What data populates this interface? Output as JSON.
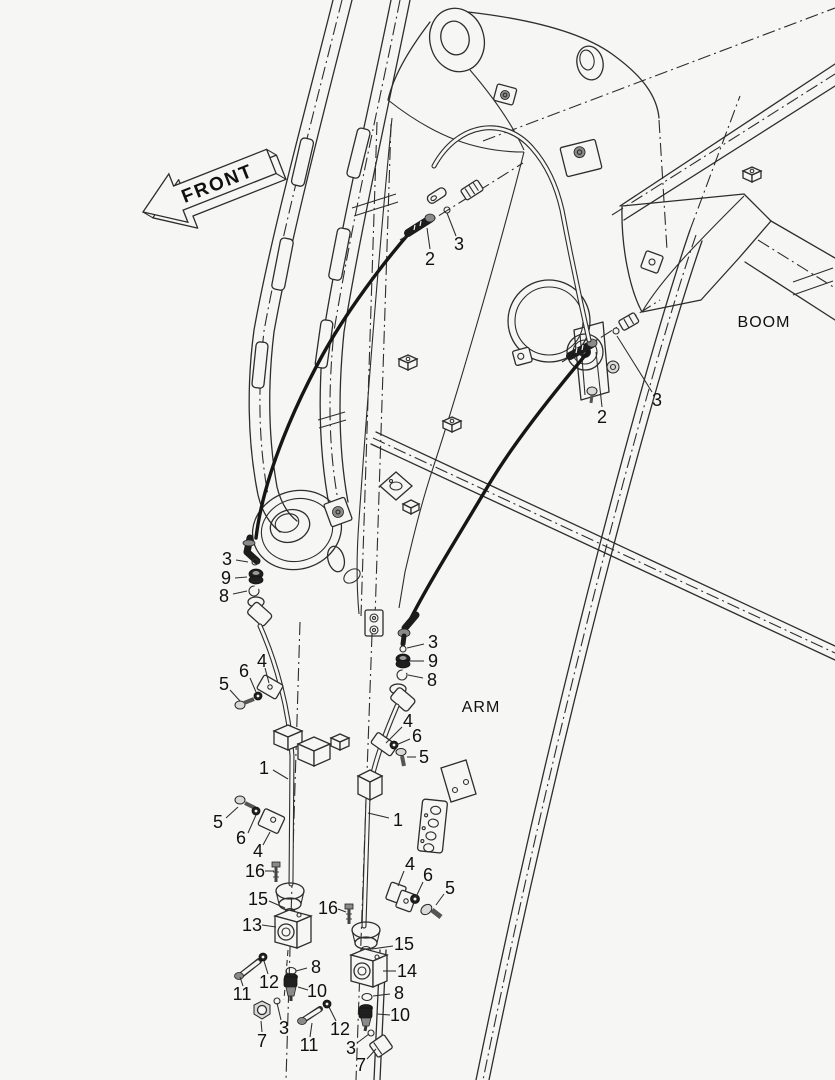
{
  "figure": {
    "background_color": "#f6f6f5",
    "line_color": "#2d2d2d",
    "hose_color": "#161616",
    "text_color": "#101010",
    "type": "exploded-parts-diagram"
  },
  "labels": {
    "front": "FRONT",
    "boom": "BOOM",
    "arm": "ARM"
  },
  "callouts": [
    {
      "text": "2",
      "x": 430,
      "y": 259,
      "sx": 430,
      "sy": 249,
      "ex": 427,
      "ey": 228
    },
    {
      "text": "3",
      "x": 459,
      "y": 244,
      "sx": 456,
      "sy": 236,
      "ex": 447,
      "ey": 213
    },
    {
      "text": "2",
      "x": 602,
      "y": 417,
      "sx": 602,
      "sy": 407,
      "ex": 596,
      "ey": 352
    },
    {
      "text": "3",
      "x": 657,
      "y": 400,
      "sx": 652,
      "sy": 392,
      "ex": 617,
      "ey": 336
    },
    {
      "text": "3",
      "x": 227,
      "y": 559,
      "sx": 236,
      "sy": 560,
      "ex": 248,
      "ey": 562
    },
    {
      "text": "9",
      "x": 226,
      "y": 578,
      "sx": 235,
      "sy": 578,
      "ex": 247,
      "ey": 577
    },
    {
      "text": "8",
      "x": 224,
      "y": 596,
      "sx": 233,
      "sy": 594,
      "ex": 247,
      "ey": 591
    },
    {
      "text": "5",
      "x": 224,
      "y": 684,
      "sx": 230,
      "sy": 690,
      "ex": 240,
      "ey": 701
    },
    {
      "text": "6",
      "x": 244,
      "y": 671,
      "sx": 250,
      "sy": 678,
      "ex": 256,
      "ey": 692
    },
    {
      "text": "4",
      "x": 262,
      "y": 661,
      "sx": 265,
      "sy": 668,
      "ex": 269,
      "ey": 683
    },
    {
      "text": "1",
      "x": 264,
      "y": 768,
      "sx": 273,
      "sy": 770,
      "ex": 288,
      "ey": 779
    },
    {
      "text": "5",
      "x": 218,
      "y": 822,
      "sx": 226,
      "sy": 818,
      "ex": 238,
      "ey": 807
    },
    {
      "text": "6",
      "x": 241,
      "y": 838,
      "sx": 248,
      "sy": 833,
      "ex": 256,
      "ey": 815
    },
    {
      "text": "4",
      "x": 258,
      "y": 851,
      "sx": 263,
      "sy": 845,
      "ex": 270,
      "ey": 832
    },
    {
      "text": "16",
      "x": 255,
      "y": 871,
      "sx": 265,
      "sy": 871,
      "ex": 274,
      "ey": 871
    },
    {
      "text": "15",
      "x": 258,
      "y": 899,
      "sx": 269,
      "sy": 901,
      "ex": 285,
      "ey": 908
    },
    {
      "text": "13",
      "x": 252,
      "y": 925,
      "sx": 262,
      "sy": 925,
      "ex": 276,
      "ey": 927
    },
    {
      "text": "16",
      "x": 328,
      "y": 908,
      "sx": 338,
      "sy": 909,
      "ex": 346,
      "ey": 912
    },
    {
      "text": "11",
      "x": 242,
      "y": 994,
      "sx": 243,
      "sy": 986,
      "ex": 240,
      "ey": 977
    },
    {
      "text": "12",
      "x": 269,
      "y": 982,
      "sx": 268,
      "sy": 974,
      "ex": 264,
      "ey": 961
    },
    {
      "text": "8",
      "x": 316,
      "y": 967,
      "sx": 307,
      "sy": 968,
      "ex": 296,
      "ey": 971
    },
    {
      "text": "10",
      "x": 317,
      "y": 991,
      "sx": 308,
      "sy": 990,
      "ex": 298,
      "ey": 987
    },
    {
      "text": "7",
      "x": 262,
      "y": 1041,
      "sx": 262,
      "sy": 1032,
      "ex": 261,
      "ey": 1021
    },
    {
      "text": "3",
      "x": 284,
      "y": 1028,
      "sx": 281,
      "sy": 1020,
      "ex": 277,
      "ey": 1003
    },
    {
      "text": "11",
      "x": 309,
      "y": 1045,
      "sx": 310,
      "sy": 1037,
      "ex": 312,
      "ey": 1023
    },
    {
      "text": "12",
      "x": 340,
      "y": 1029,
      "sx": 336,
      "sy": 1021,
      "ex": 329,
      "ey": 1007
    },
    {
      "text": "3",
      "x": 433,
      "y": 642,
      "sx": 424,
      "sy": 644,
      "ex": 407,
      "ey": 648
    },
    {
      "text": "9",
      "x": 433,
      "y": 661,
      "sx": 424,
      "sy": 661,
      "ex": 410,
      "ey": 661
    },
    {
      "text": "8",
      "x": 432,
      "y": 680,
      "sx": 423,
      "sy": 678,
      "ex": 408,
      "ey": 675
    },
    {
      "text": "4",
      "x": 408,
      "y": 721,
      "sx": 402,
      "sy": 727,
      "ex": 386,
      "ey": 743
    },
    {
      "text": "6",
      "x": 417,
      "y": 736,
      "sx": 410,
      "sy": 739,
      "ex": 396,
      "ey": 745
    },
    {
      "text": "5",
      "x": 424,
      "y": 757,
      "sx": 416,
      "sy": 757,
      "ex": 407,
      "ey": 757
    },
    {
      "text": "1",
      "x": 398,
      "y": 820,
      "sx": 389,
      "sy": 818,
      "ex": 368,
      "ey": 813
    },
    {
      "text": "4",
      "x": 410,
      "y": 864,
      "sx": 404,
      "sy": 871,
      "ex": 398,
      "ey": 886
    },
    {
      "text": "6",
      "x": 428,
      "y": 875,
      "sx": 423,
      "sy": 882,
      "ex": 416,
      "ey": 897
    },
    {
      "text": "5",
      "x": 450,
      "y": 888,
      "sx": 444,
      "sy": 894,
      "ex": 436,
      "ey": 905
    },
    {
      "text": "15",
      "x": 404,
      "y": 944,
      "sx": 393,
      "sy": 946,
      "ex": 372,
      "ey": 949
    },
    {
      "text": "14",
      "x": 407,
      "y": 971,
      "sx": 396,
      "sy": 971,
      "ex": 383,
      "ey": 971
    },
    {
      "text": "8",
      "x": 399,
      "y": 993,
      "sx": 390,
      "sy": 994,
      "ex": 373,
      "ey": 996
    },
    {
      "text": "10",
      "x": 400,
      "y": 1015,
      "sx": 390,
      "sy": 1015,
      "ex": 377,
      "ey": 1014
    },
    {
      "text": "3",
      "x": 351,
      "y": 1048,
      "sx": 357,
      "sy": 1043,
      "ex": 369,
      "ey": 1034
    },
    {
      "text": "7",
      "x": 361,
      "y": 1065,
      "sx": 367,
      "sy": 1059,
      "ex": 376,
      "ey": 1049
    }
  ]
}
